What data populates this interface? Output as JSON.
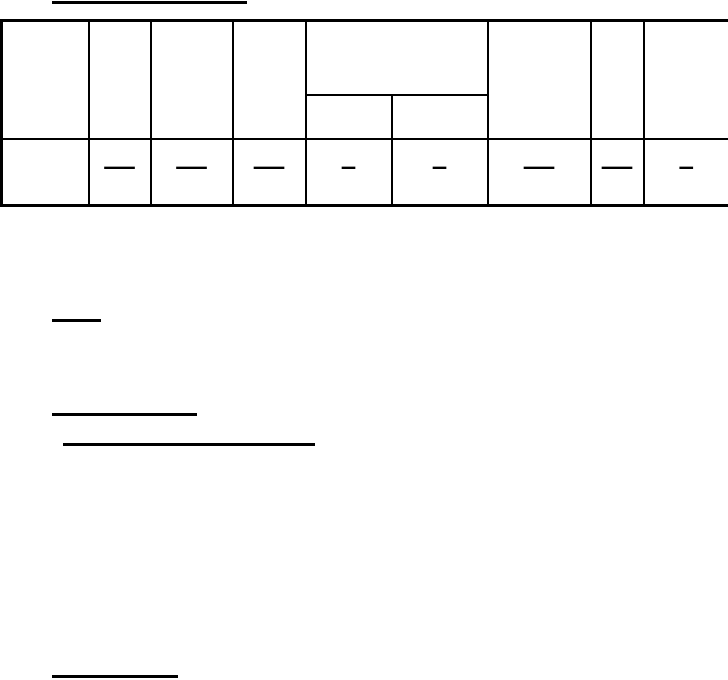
{
  "document": {
    "background_color": "#ffffff",
    "line_color": "#000000"
  },
  "rules": [
    {
      "name": "title-underline",
      "x": 52,
      "y": 1,
      "width": 195,
      "height": 3
    },
    {
      "name": "underline-1",
      "x": 52,
      "y": 319,
      "width": 49,
      "height": 3
    },
    {
      "name": "underline-2",
      "x": 52,
      "y": 413,
      "width": 145,
      "height": 3
    },
    {
      "name": "underline-3",
      "x": 63,
      "y": 443,
      "width": 252,
      "height": 3
    },
    {
      "name": "underline-4",
      "x": 52,
      "y": 675,
      "width": 126,
      "height": 3
    }
  ],
  "table": {
    "header": {
      "col1": "",
      "col2": "",
      "col3": "",
      "col4": "",
      "col5_group": "",
      "col5a": "",
      "col5b": "",
      "col6": "",
      "col7": "",
      "col8": ""
    },
    "data_row": [
      "",
      "—",
      "—",
      "—",
      "–",
      "–",
      "—",
      "—",
      "–"
    ]
  }
}
